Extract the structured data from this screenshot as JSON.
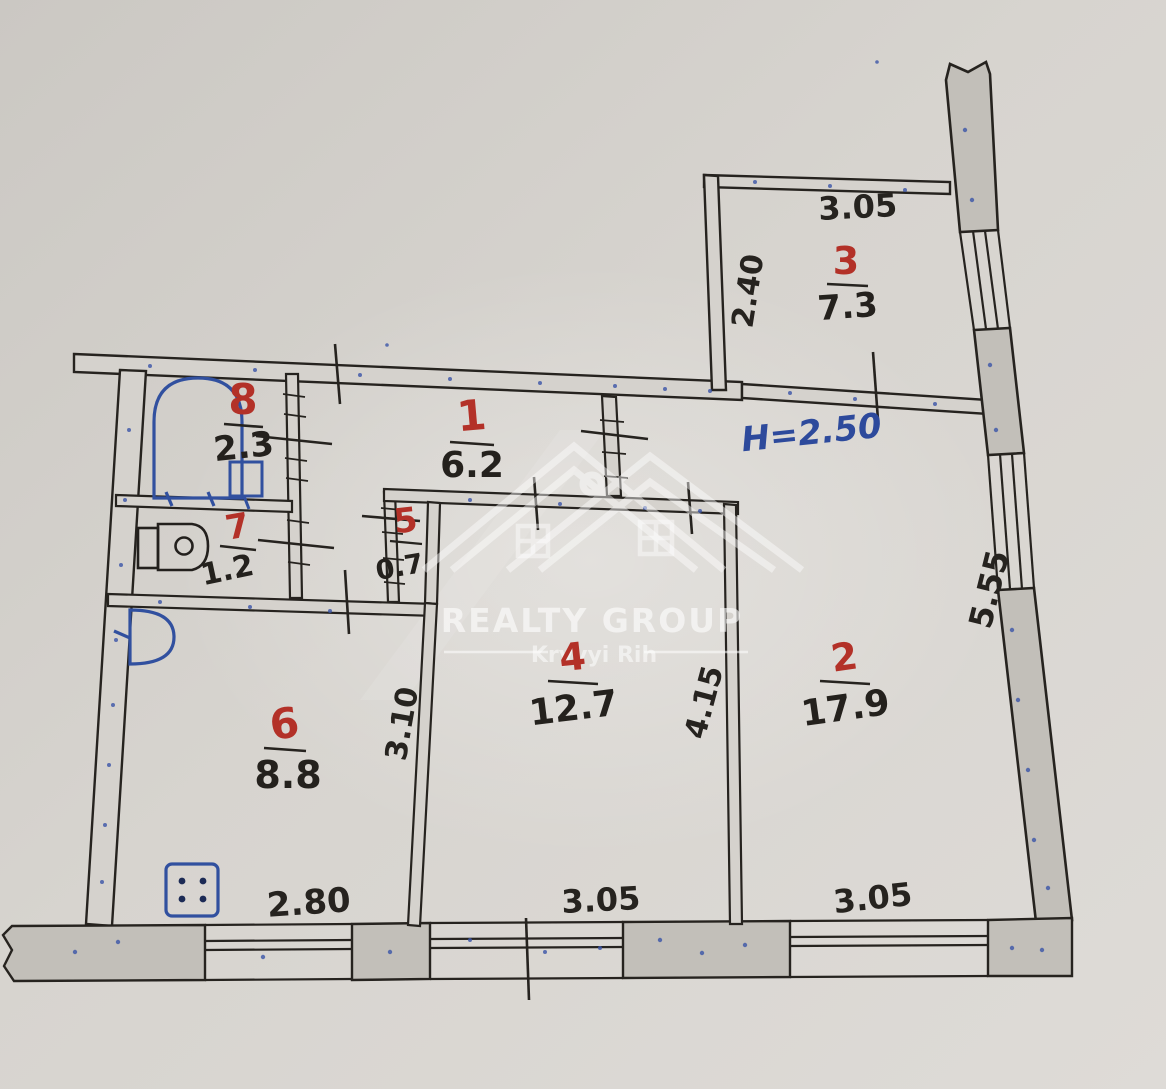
{
  "plan": {
    "title_watermark": {
      "title": "REALTY GROUP",
      "subtitle": "Kryvyi Rih"
    },
    "height_note": "Н=2.50",
    "rooms": [
      {
        "number": "1",
        "area": "6.2"
      },
      {
        "number": "2",
        "area": "17.9"
      },
      {
        "number": "3",
        "area": "7.3"
      },
      {
        "number": "4",
        "area": "12.7"
      },
      {
        "number": "5",
        "area": "0.7"
      },
      {
        "number": "6",
        "area": "8.8"
      },
      {
        "number": "7",
        "area": "1.2"
      },
      {
        "number": "8",
        "area": "2.3"
      }
    ],
    "dimensions": {
      "balcony_width": "3.05",
      "balcony_depth": "2.40",
      "right_side": "5.55",
      "kitchen_depth": "3.10",
      "room4_depth": "4.15",
      "kitchen_width": "2.80",
      "room4_width": "3.05",
      "room2_width": "3.05"
    },
    "colors": {
      "paper": "#d6d3ce",
      "ink": "#26231f",
      "red": "#b33128",
      "blue": "#2d4a9c",
      "wall_fill": "#c2bfb9"
    }
  }
}
